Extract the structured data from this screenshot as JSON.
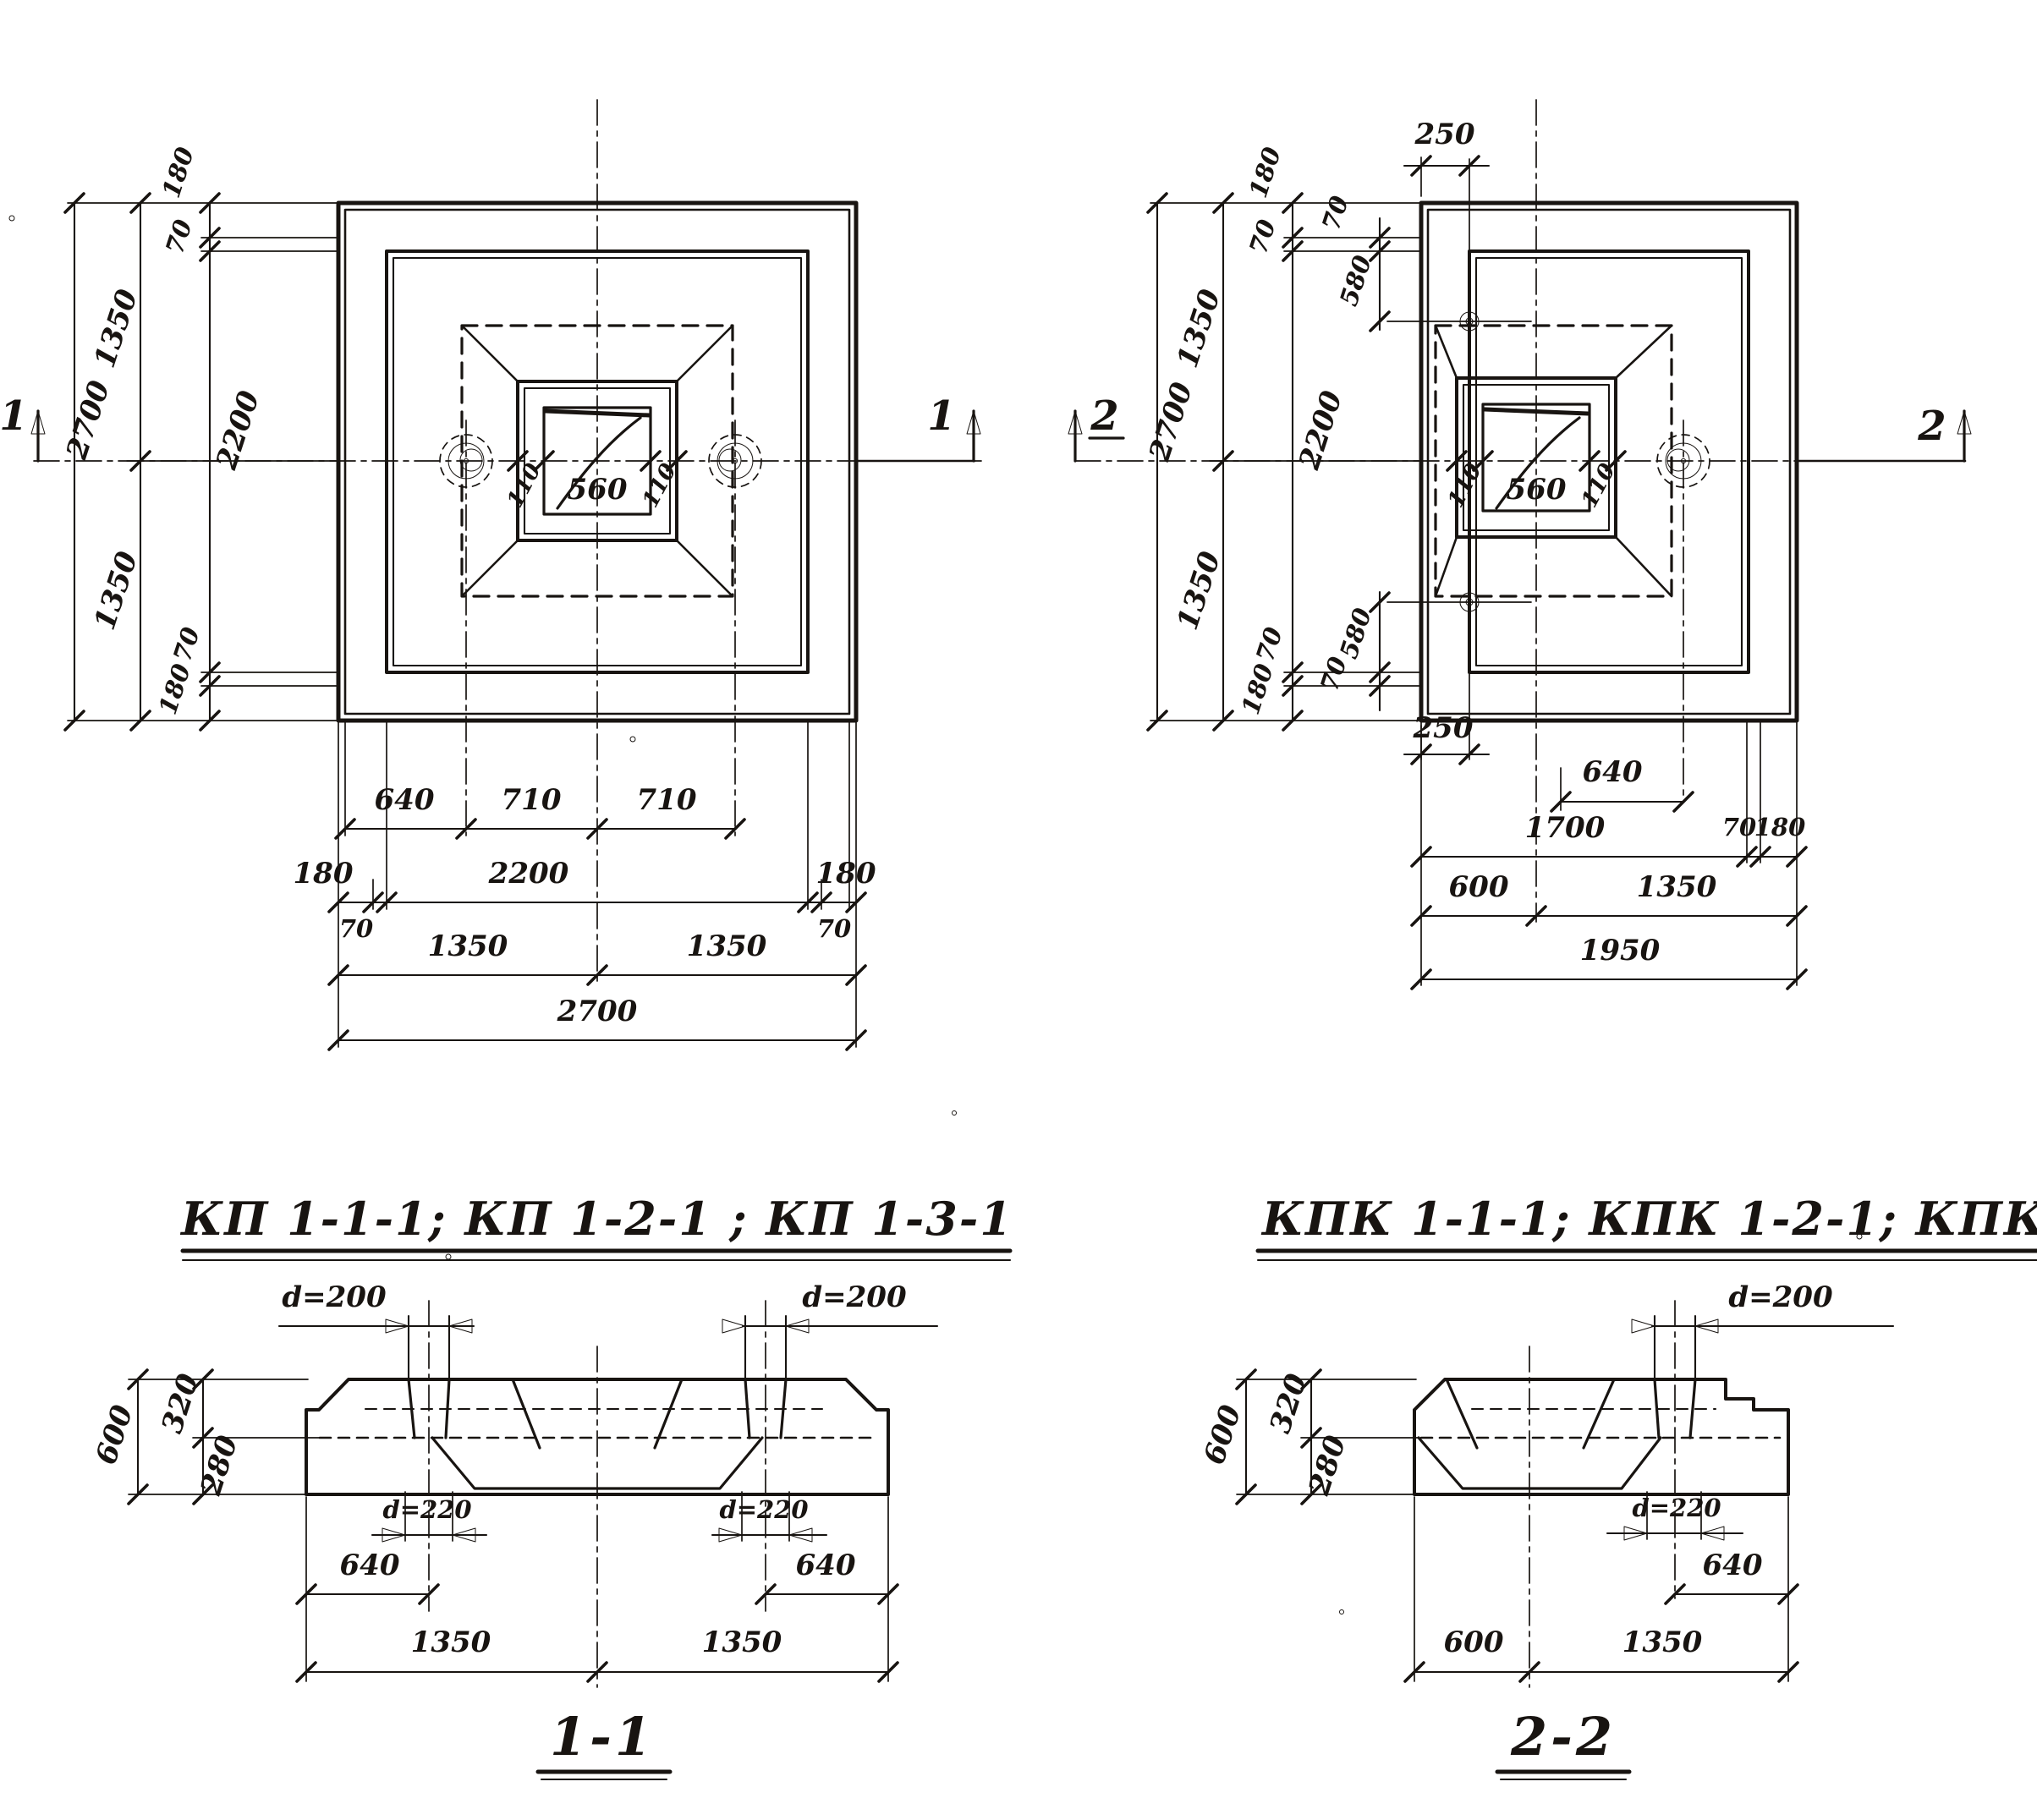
{
  "plan_kp": {
    "title": "КП 1-1-1; КП 1-2-1 ; КП 1-3-1",
    "marker": "1",
    "left": {
      "total": "2700",
      "half_top": "1350",
      "half_bot": "1350",
      "e_top": "180",
      "g_top": "70",
      "inner": "2200",
      "g_bot": "70",
      "e_bot": "180"
    },
    "center": {
      "l": "110",
      "mid": "560",
      "r": "110"
    },
    "bottom": {
      "r1": [
        "640",
        "710",
        "710"
      ],
      "r2": [
        "180",
        "2200",
        "180"
      ],
      "r2s": [
        "70",
        "70"
      ],
      "r3": [
        "1350",
        "1350"
      ],
      "r4": "2700"
    }
  },
  "plan_kpk": {
    "title": "КПК 1-1-1; КПК 1-2-1; КПК 1-3-1",
    "marker": "2",
    "left": {
      "total": "2700",
      "half_top": "1350",
      "half_bot": "1350",
      "e_top": "180",
      "g_top": "70",
      "inner": "2200",
      "g_bot": "70",
      "e_bot": "180"
    },
    "hole_dims": {
      "top": [
        "70",
        "580"
      ],
      "bottom": [
        "70",
        "580"
      ],
      "offset_top": "250",
      "offset_bot": "250",
      "offset_r": "640"
    },
    "center": {
      "l": "110",
      "mid": "560",
      "r": "110"
    },
    "bottom": {
      "r1": [
        "1700",
        "70",
        "180"
      ],
      "r2": [
        "600",
        "1350"
      ],
      "r3": "1950"
    }
  },
  "section_1": {
    "title": "1-1",
    "d_top": [
      "d=200",
      "d=200"
    ],
    "left": {
      "total": "600",
      "top": "320",
      "bot": "280"
    },
    "d_bot": [
      "d=220",
      "d=220"
    ],
    "offsets": [
      "640",
      "640"
    ],
    "row": [
      "1350",
      "1350"
    ]
  },
  "section_2": {
    "title": "2-2",
    "d_top": "d=200",
    "left": {
      "total": "600",
      "top": "320",
      "bot": "280"
    },
    "d_bot": "d=220",
    "offset": "640",
    "row": [
      "600",
      "1350"
    ]
  }
}
